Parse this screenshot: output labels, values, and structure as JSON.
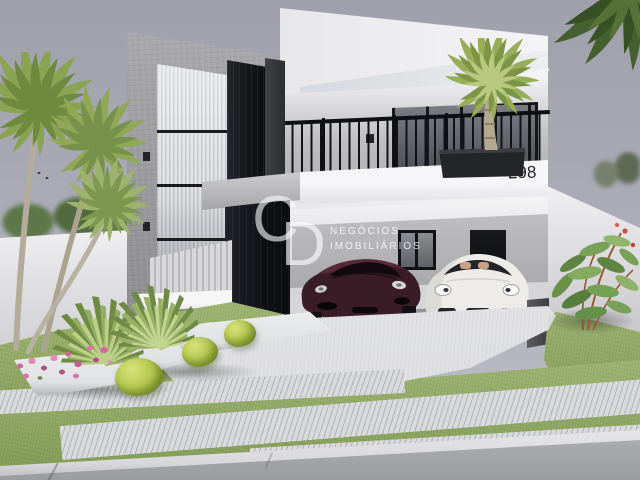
{
  "watermark": {
    "letter_c": "C",
    "letter_d": "D",
    "line1": "NEGÓCIOS",
    "line2": "IMOBILIÁRIOS"
  },
  "house": {
    "number": "298"
  },
  "colors": {
    "sky": "#a9aab5",
    "concrete": "#9c9c9e",
    "black_panel": "#14161a",
    "white_wall": "#efeff1",
    "fascia": "#f6f6f8",
    "beam": "#b6b6b9",
    "balcony_wall": "#bfbfc2",
    "railing": "#101215",
    "garage_wall": "#b1b0b3",
    "garage_floor": "#d7d7d9",
    "driveway": "#dedfe1",
    "paver": "#d9dadc",
    "street": "#9b9ca0",
    "curb": "#d8d8db",
    "grass": "#a0b573",
    "grass_dark": "#7f9b54",
    "palm": "#8aa351",
    "palm_dark": "#5d7a36",
    "palm_light": "#b2c47d",
    "trunk": "#b4ab9b",
    "car_maroon": "#3a1c26",
    "car_white": "#eeece9",
    "flower_pink": "#d2679c",
    "shrub": "#b7ca52",
    "planter": "#232528",
    "bush_green": "#5f8a42"
  }
}
